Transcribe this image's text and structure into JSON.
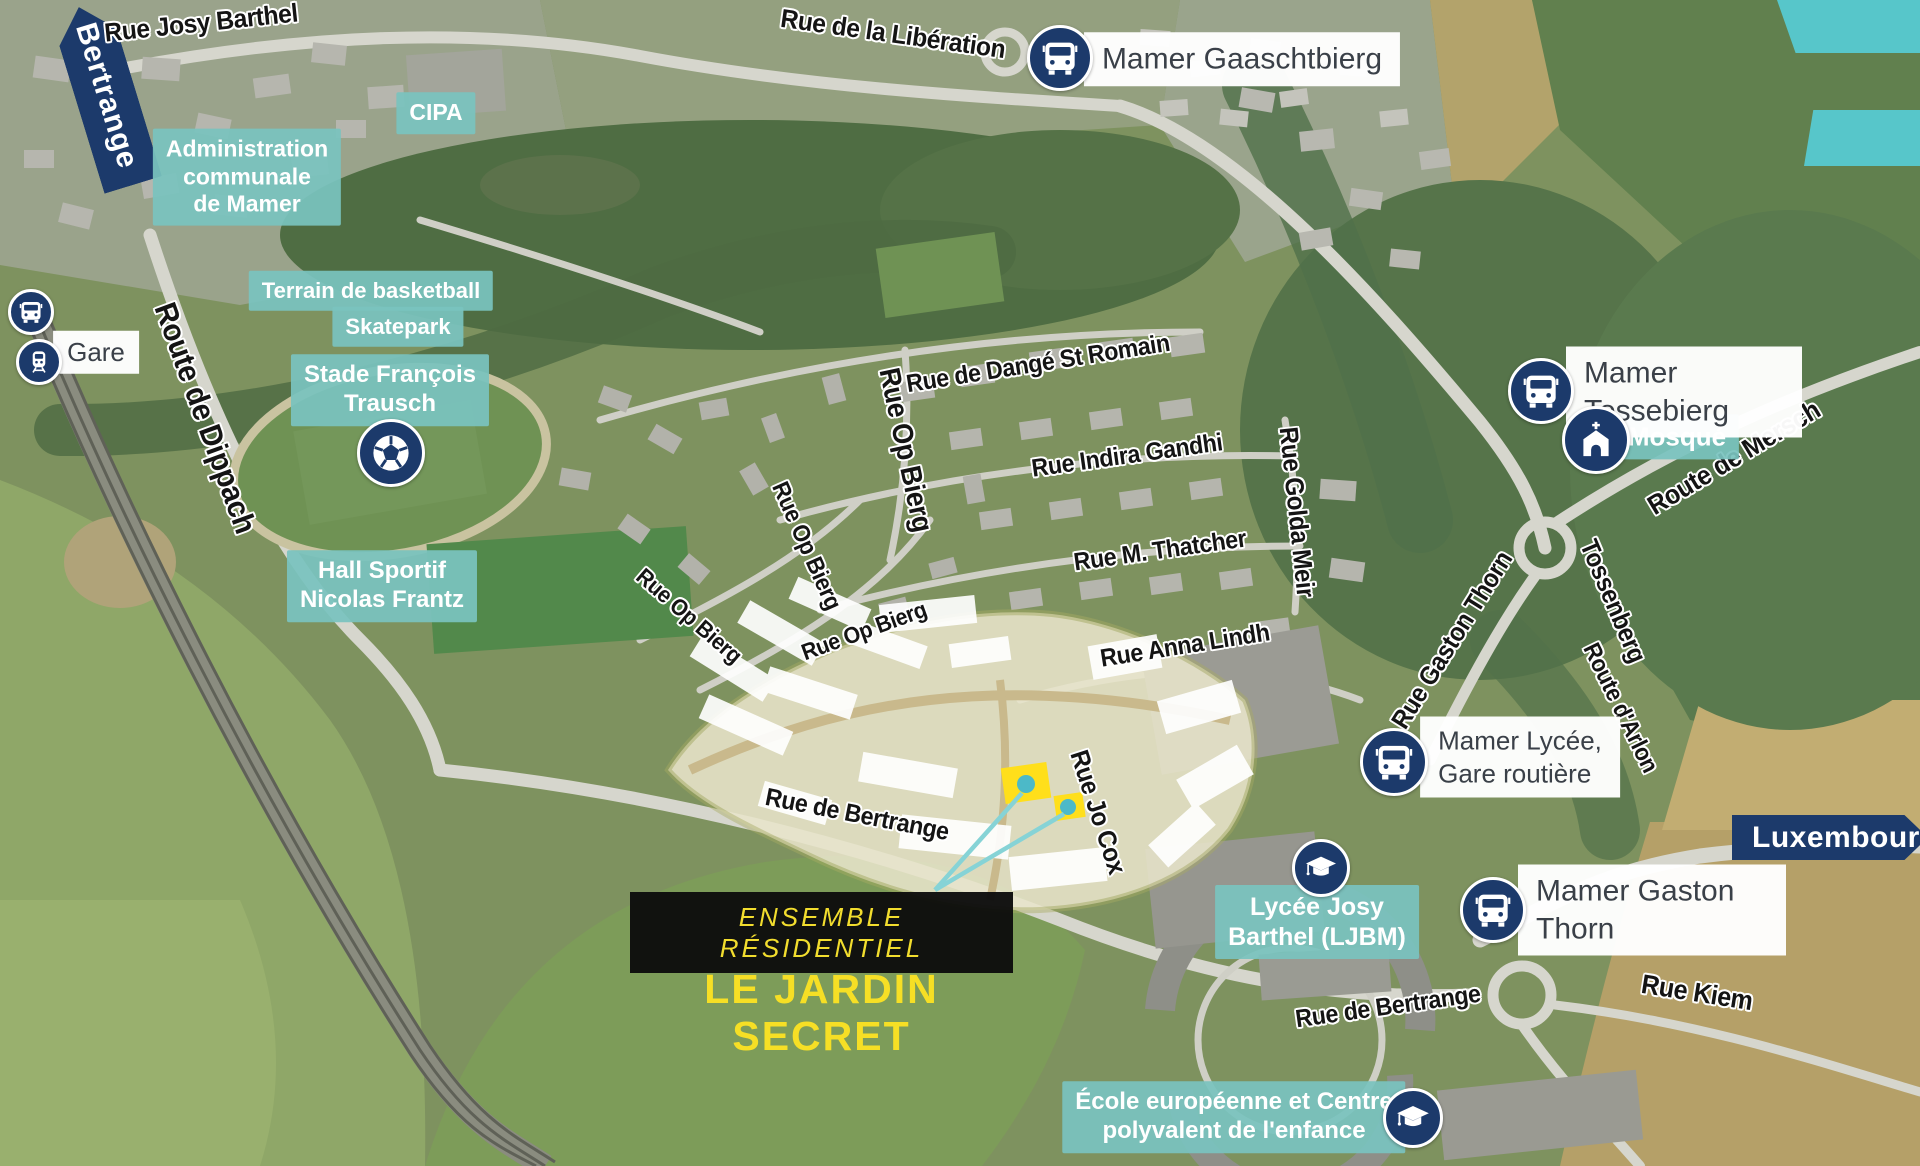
{
  "meta": {
    "title": "Plan de situation aérien — Le Jardin Secret, Mamer"
  },
  "site": {
    "line1": "ENSEMBLE RÉSIDENTIEL",
    "line2": "LE JARDIN SECRET"
  },
  "directions": {
    "bertrange": "Bertrange",
    "luxembourg": "Luxembourg"
  },
  "streets": {
    "josyBarthel": "Rue Josy Barthel",
    "liberation": "Rue de la Libération",
    "dippach": "Route de Dippach",
    "dange": "Rue de Dangé St Romain",
    "indira": "Rue Indira Gandhi",
    "thatcher": "Rue M. Thatcher",
    "goldaMeir": "Rue Golda Meir",
    "opBierg": "Rue Op Bierg",
    "annaLindh": "Rue Anna Lindh",
    "bertrange": "Rue de Bertrange",
    "joCox": "Rue Jo Cox",
    "gastonThorn": "Rue Gaston Thorn",
    "mersch": "Route de Mersch",
    "tossenberg": "Tossenberg",
    "arlon": "Route d'Arlon",
    "kiem": "Rue Kiem"
  },
  "places": {
    "cipa": "CIPA",
    "admin": "Administration\ncommunale\nde Mamer",
    "basketball": "Terrain de basketball",
    "skatepark": "Skatepark",
    "stade": "Stade François\nTrausch",
    "hall": "Hall Sportif\nNicolas Frantz",
    "mosque": "Mosqué",
    "lycee": "Lycée Josy\nBarthel (LJBM)",
    "ecole": "École européenne et Centre\npolyvalent de l'enfance"
  },
  "stops": {
    "gare": "Gare",
    "gaaschtbierg": "Mamer Gaaschtbierg",
    "tossebierg": "Mamer Tossebierg",
    "lyceeGare": "Mamer Lycée,\nGare routière",
    "gastonThorn": "Mamer Gaston Thorn"
  },
  "icons": [
    "bus-icon",
    "train-icon",
    "church-icon",
    "graduation-cap-icon",
    "soccer-ball-icon"
  ],
  "colors": {
    "navy": "#1c3a6b",
    "teal_label": "#7ac3be",
    "corner_teal": "#57c6ca",
    "site_yellow": "#f6df25",
    "highlight_yellow": "#ffdf1b",
    "leader_line": "#86d3d6"
  }
}
